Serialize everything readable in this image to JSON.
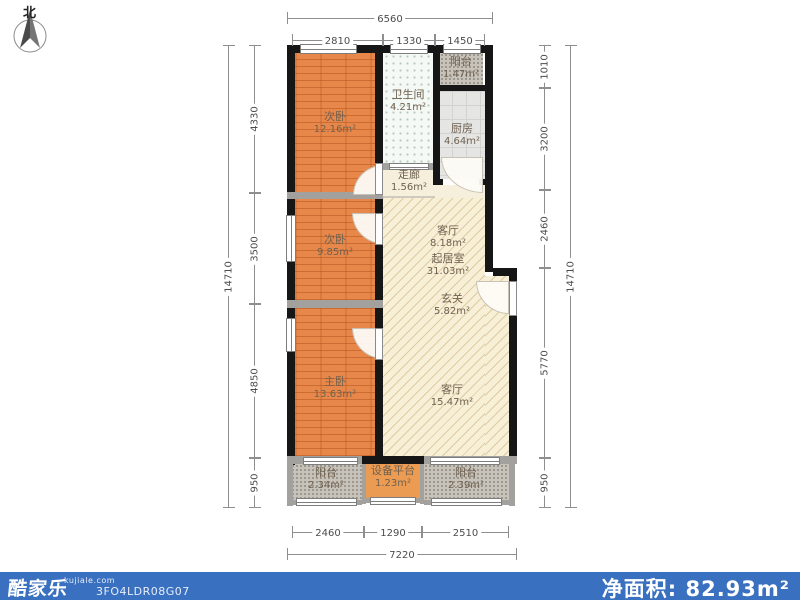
{
  "compass": {
    "label": "北"
  },
  "rooms": [
    {
      "name": "次卧",
      "area": "12.16m²"
    },
    {
      "name": "卫生间",
      "area": "4.21m²"
    },
    {
      "name": "阳台",
      "area": "1.47m²"
    },
    {
      "name": "厨房",
      "area": "4.64m²"
    },
    {
      "name": "走廊",
      "area": "1.56m²"
    },
    {
      "name": "次卧",
      "area": "9.85m²"
    },
    {
      "name": "客厅",
      "area": "8.18m²"
    },
    {
      "name": "起居室",
      "area": "31.03m²"
    },
    {
      "name": "玄关",
      "area": "5.82m²"
    },
    {
      "name": "主卧",
      "area": "13.63m²"
    },
    {
      "name": "客厅",
      "area": "15.47m²"
    },
    {
      "name": "阳台",
      "area": "2.34m²"
    },
    {
      "name": "设备平台",
      "area": "1.23m²"
    },
    {
      "name": "阳台",
      "area": "2.39m²"
    }
  ],
  "dimensions": {
    "top": {
      "total": "6560",
      "segments": [
        "2810",
        "1330",
        "1450"
      ]
    },
    "bottom": {
      "total": "7220",
      "segments": [
        "2460",
        "1290",
        "2510"
      ]
    },
    "left": {
      "total": "14710",
      "segments": [
        "4330",
        "3500",
        "4850",
        "950"
      ]
    },
    "right": {
      "total": "14710",
      "segments": [
        "1010",
        "3200",
        "2460",
        "5770",
        "950"
      ]
    }
  },
  "footer": {
    "logo": "酷家乐",
    "domain": "kujiale.com",
    "plan_code": "3FO4LDR08G07",
    "net_area_label": "净面积:",
    "net_area_value": "82.93m²"
  },
  "colors": {
    "footer_bar": "#3a70c0",
    "bedroom_floor": "#e8874a",
    "living_floor": "#f7efd6",
    "balcony_floor": "#c8c3ba",
    "kitchen_floor": "#e5e5e3",
    "wall": "#161616"
  }
}
